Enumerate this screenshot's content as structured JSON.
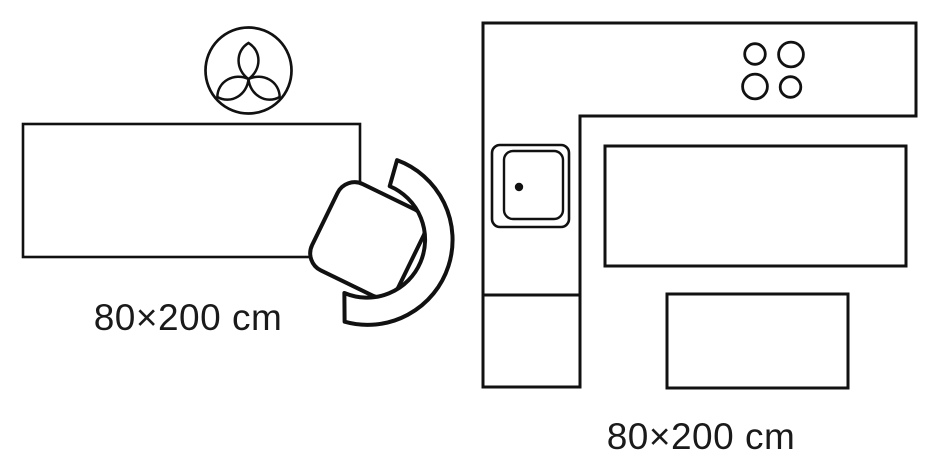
{
  "colors": {
    "background": "#ffffff",
    "outline": "#111111",
    "rug_fill": "#d8d8d8",
    "label_text": "#1a1a1a"
  },
  "scenes": {
    "living_room": {
      "size_label": "80×200 cm",
      "elements": [
        "plant-top-view",
        "rug",
        "chair-top-view"
      ]
    },
    "kitchen": {
      "size_label": "80×200 cm",
      "elements": [
        "l-shaped-counter",
        "sink",
        "hob-4-burners",
        "runner-rug",
        "table"
      ]
    }
  }
}
